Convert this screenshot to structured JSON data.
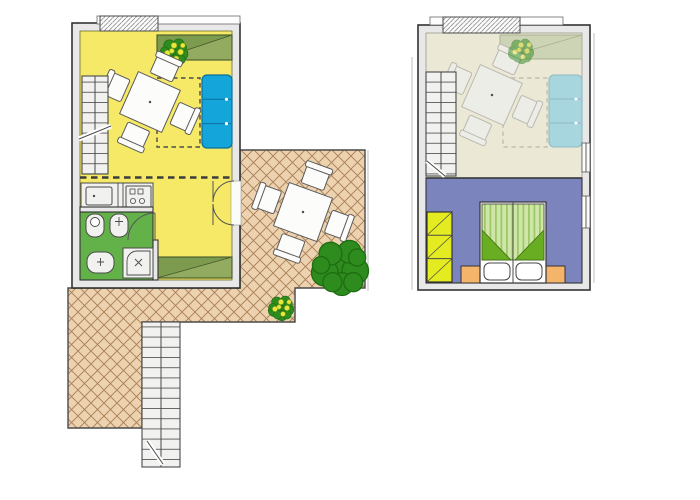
{
  "colors": {
    "canvas": "#ffffff",
    "line": "#333333",
    "wall-fill": "#e8e8e8",
    "living-floor": "#f5e967",
    "bath-floor": "#63b249",
    "gallery-floor": "#ebe9d6",
    "bedroom-floor": "#7b84bd",
    "sofa": "#14a5da",
    "sofa-line": "#0c6f9c",
    "sofa-faded": "#a7d6de",
    "sideboard": "#93ab60",
    "sideboard-dark": "#7d9b4f",
    "sideboard-line": "#44582a",
    "sideboard-faded": "#cdd3b5",
    "terrace-bg": "#ecd2ae",
    "terrace-line": "#a87e58",
    "wardrobe": "#e4eb20",
    "nightstand": "#f4b469",
    "bed-fold": "#68ad22",
    "duvet-light": "#cfe6a8",
    "duvet-dark": "#9dc969",
    "plant-green": "#2e8c1e",
    "plant-dark": "#1e6d12",
    "plant-dot": "#e6e93c",
    "stair-fill": "#f1f1f0",
    "step-line": "#5a5a5a",
    "furn-fill": "#fcfcfa",
    "furn-line": "#5a5a5a"
  }
}
